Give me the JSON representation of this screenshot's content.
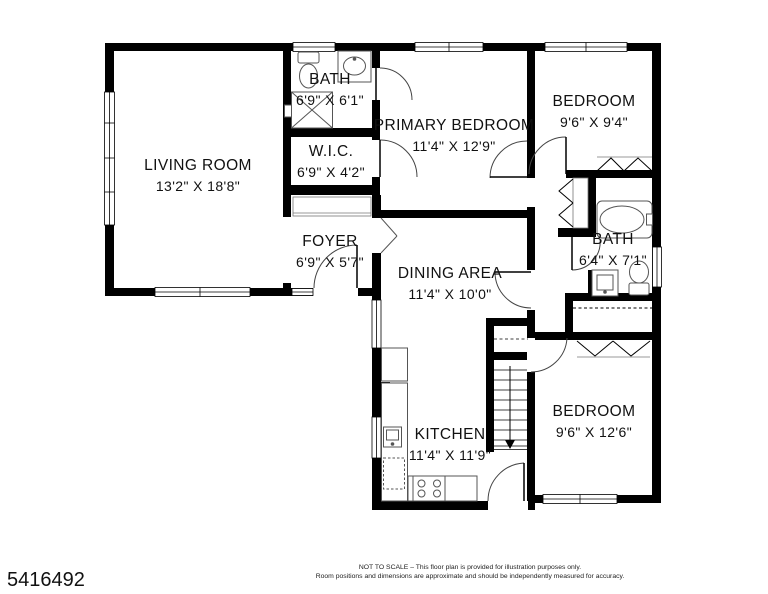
{
  "plan": {
    "id": "5416492",
    "disclaimer_line1": "NOT TO SCALE – This floor plan is provided for illustration purposes only.",
    "disclaimer_line2": "Room positions and dimensions are approximate and should be independently measured for accuracy."
  },
  "rooms": [
    {
      "name": "LIVING ROOM",
      "dims": "13'2\" X 18'8\""
    },
    {
      "name": "BATH",
      "dims": "6'9\" X 6'1\""
    },
    {
      "name": "W.I.C.",
      "dims": "6'9\" X 4'2\""
    },
    {
      "name": "PRIMARY BEDROOM",
      "dims": "11'4\" X 12'9\""
    },
    {
      "name": "BEDROOM",
      "dims": "9'6\" X 9'4\""
    },
    {
      "name": "FOYER",
      "dims": "6'9\" X 5'7\""
    },
    {
      "name": "DINING AREA",
      "dims": "11'4\" X 10'0\""
    },
    {
      "name": "BATH",
      "dims": "6'4\" X 7'1\""
    },
    {
      "name": "KITCHEN",
      "dims": "11'4\" X 11'9\""
    },
    {
      "name": "BEDROOM",
      "dims": "9'6\" X 12'6\""
    }
  ]
}
